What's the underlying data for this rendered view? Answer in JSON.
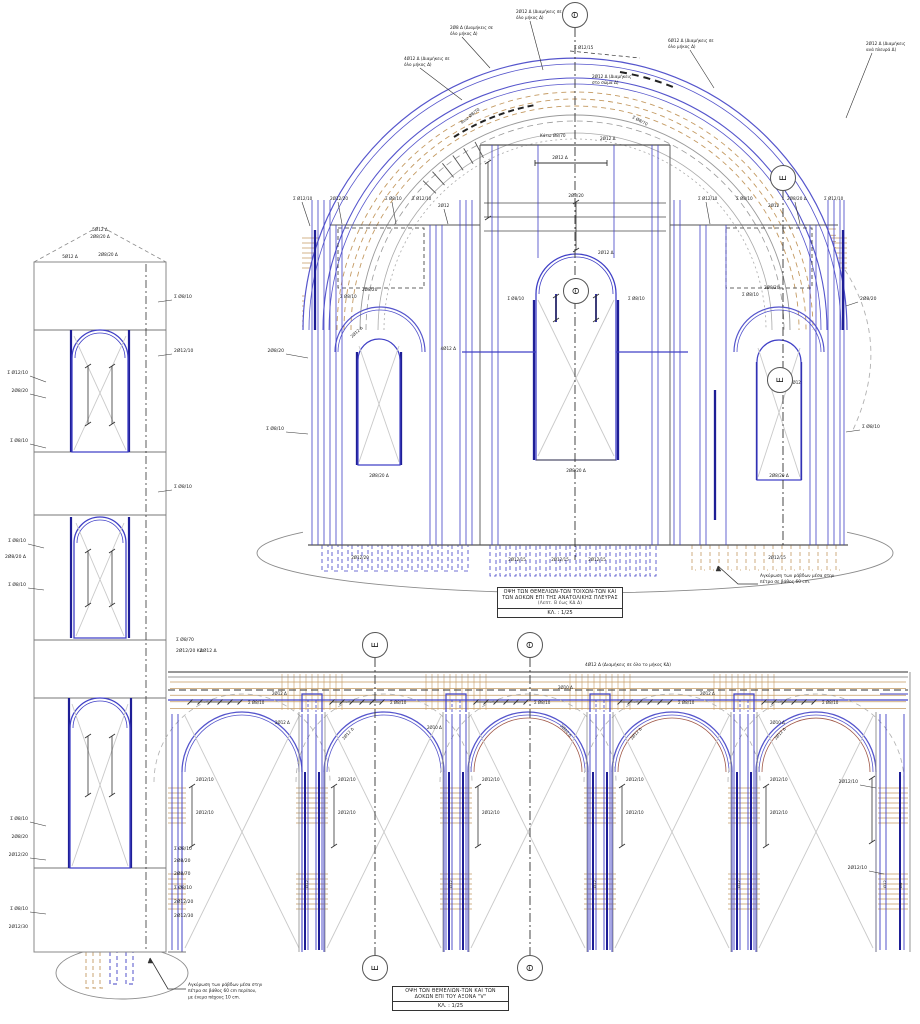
{
  "drawing": {
    "title_block_east": {
      "line1": "ΟΨΗ ΤΩΝ ΘΕΜΕΛΙΩΝ-ΤΩΝ ΤΟΙΧΩΝ-ΤΩΝ ΚΑΙ",
      "line2": "ΤΩΝ ΔΟΚΩΝ ΕΠΙ ΤΗΣ ΑΝΑΤΟΛΙΚΗΣ ΠΛΕΥΡΑΣ",
      "line3": "(Λεπτ. Β έως ΚΔ Δ)",
      "scale": "ΚΛ. : 1/25"
    },
    "title_block_axis_v": {
      "line1": "ΟΨΗ ΤΩΝ ΘΕΜΕΛΙΩΝ-ΤΩΝ ΚΑΙ ΤΩΝ",
      "line2": "ΔΟΚΩΝ ΕΠΙ ΤΟΥ ΑΞΟΝΑ \"V\"",
      "scale": "ΚΛ. : 1/25"
    },
    "colors": {
      "rebar_blue": "#4040c6",
      "rebar_navy": "#1e1e96",
      "arc_blue": "#5555cc",
      "stirrup_tan": "#c49a62",
      "outline_gray": "#8a8a8a",
      "cross_gray": "#c9c9c9",
      "axis_black": "#333333",
      "accent_brown": "#a05848"
    },
    "axis_markers": [
      {
        "glyph": "Θ",
        "x": 575,
        "y": 15,
        "line": [
          575,
          28,
          575,
          560
        ]
      },
      {
        "glyph": "E",
        "x": 783,
        "y": 178,
        "line": [
          783,
          191,
          783,
          545
        ]
      },
      {
        "glyph": "Θ",
        "x": 576,
        "y": 291
      },
      {
        "glyph": "E",
        "x": 780,
        "y": 380
      },
      {
        "glyph": "E",
        "x": 375,
        "y": 645,
        "line": [
          375,
          658,
          375,
          955
        ]
      },
      {
        "glyph": "Θ",
        "x": 530,
        "y": 645,
        "line": [
          530,
          658,
          530,
          955
        ]
      },
      {
        "glyph": "E",
        "x": 375,
        "y": 968
      },
      {
        "glyph": "Θ",
        "x": 530,
        "y": 968
      }
    ],
    "notes": {
      "tower_anchor_1": "Αγκύρωση των ράβδων μέσα στην",
      "tower_anchor_2": "πέτρα σε βάθος 60 cm περίπου,",
      "tower_anchor_3": "με ένεμα πάχους 10 cm.",
      "facade_anchor_1": "Αγκύρωση των ράβδων μέσα στην",
      "facade_anchor_2": "πέτρα σε βάθος 60 cm."
    },
    "ann": [
      {
        "t": "5Ø12 Δ",
        "x": 100,
        "y": 231,
        "a": "m",
        "s": 4.2
      },
      {
        "t": "2Ø8/20 Δ",
        "x": 100,
        "y": 238,
        "a": "m",
        "s": 4.2
      },
      {
        "t": "2Ø8/20 Δ",
        "x": 108,
        "y": 256,
        "a": "m",
        "s": 4.2
      },
      {
        "t": "5Ø12 Δ",
        "x": 70,
        "y": 258,
        "a": "m",
        "s": 4.2
      },
      {
        "t": "Σ Ø12/10",
        "x": 28,
        "y": 374,
        "a": "e",
        "ld": [
          [
            30,
            376
          ],
          [
            46,
            382
          ]
        ]
      },
      {
        "t": "2Ø8/20",
        "x": 28,
        "y": 392,
        "a": "e",
        "ld": [
          [
            30,
            394
          ],
          [
            46,
            398
          ]
        ]
      },
      {
        "t": "Σ Ø8/10",
        "x": 28,
        "y": 442,
        "a": "e",
        "ld": [
          [
            30,
            444
          ],
          [
            46,
            448
          ]
        ]
      },
      {
        "t": "Σ Ø8/10",
        "x": 26,
        "y": 542,
        "a": "e",
        "ld": [
          [
            28,
            544
          ],
          [
            44,
            548
          ]
        ]
      },
      {
        "t": "2Ø8/20 Δ",
        "x": 26,
        "y": 558,
        "a": "e"
      },
      {
        "t": "Σ Ø8/10",
        "x": 26,
        "y": 586,
        "a": "e",
        "ld": [
          [
            28,
            588
          ],
          [
            44,
            590
          ]
        ]
      },
      {
        "t": "Σ Ø8/10",
        "x": 28,
        "y": 820,
        "a": "e",
        "ld": [
          [
            30,
            822
          ],
          [
            46,
            826
          ]
        ]
      },
      {
        "t": "2Ø8/20",
        "x": 28,
        "y": 838,
        "a": "e"
      },
      {
        "t": "2Ø12/20",
        "x": 28,
        "y": 856,
        "a": "e",
        "ld": [
          [
            30,
            858
          ],
          [
            46,
            860
          ]
        ]
      },
      {
        "t": "Σ Ø8/10",
        "x": 28,
        "y": 910,
        "a": "e",
        "ld": [
          [
            30,
            912
          ],
          [
            46,
            914
          ]
        ]
      },
      {
        "t": "2Ø12/30",
        "x": 28,
        "y": 928,
        "a": "e"
      },
      {
        "t": "Σ Ø8/10",
        "x": 174,
        "y": 298,
        "ld": [
          [
            172,
            300
          ],
          [
            158,
            302
          ]
        ]
      },
      {
        "t": "2Ø12/10",
        "x": 174,
        "y": 352,
        "ld": [
          [
            172,
            354
          ],
          [
            158,
            356
          ]
        ]
      },
      {
        "t": "Σ Ø8/10",
        "x": 174,
        "y": 488,
        "ld": [
          [
            172,
            490
          ],
          [
            158,
            492
          ]
        ]
      },
      {
        "t": "Σ Ø8/70",
        "x": 176,
        "y": 641
      },
      {
        "t": "2Ø12/20 ΚΔ",
        "x": 176,
        "y": 652
      },
      {
        "t": "2Ø12 Δ",
        "x": 200,
        "y": 652
      },
      {
        "t": "Σ Ø8/10",
        "x": 174,
        "y": 850
      },
      {
        "t": "2Ø8/20",
        "x": 174,
        "y": 862
      },
      {
        "t": "2Ø8/70",
        "x": 174,
        "y": 875
      },
      {
        "t": "Σ Ø8/10",
        "x": 174,
        "y": 889
      },
      {
        "t": "2Ø12/20",
        "x": 174,
        "y": 903
      },
      {
        "t": "2Ø12/30",
        "x": 174,
        "y": 917
      },
      {
        "t": "2Ø12 Δ (Διαμήκεις σε",
        "x": 516,
        "y": 13,
        "s": 4.2,
        "ld": [
          [
            530,
            21
          ],
          [
            543,
            70
          ]
        ]
      },
      {
        "t": "όλο μήκος Δ)",
        "x": 516,
        "y": 19,
        "s": 4.2
      },
      {
        "t": "2Ø8 Δ (Διαμήκεις σε",
        "x": 450,
        "y": 29,
        "s": 4.2,
        "ld": [
          [
            462,
            37
          ],
          [
            490,
            68
          ]
        ]
      },
      {
        "t": "όλο μήκος Δ)",
        "x": 450,
        "y": 35,
        "s": 4.2
      },
      {
        "t": "4Ø12 Δ (Διαμήκεις σε",
        "x": 404,
        "y": 60,
        "s": 4.2,
        "ld": [
          [
            420,
            68
          ],
          [
            462,
            100
          ]
        ]
      },
      {
        "t": "όλο μήκος Δ)",
        "x": 404,
        "y": 66,
        "s": 4.2
      },
      {
        "t": "6Ø12 Δ (Διαμήκεις σε",
        "x": 668,
        "y": 42,
        "s": 4.2,
        "ld": [
          [
            690,
            50
          ],
          [
            714,
            88
          ]
        ]
      },
      {
        "t": "όλο μήκος Δ)",
        "x": 668,
        "y": 48,
        "s": 4.2
      },
      {
        "t": "2Ø12 Δ (Διαμήκεις",
        "x": 866,
        "y": 45,
        "s": 4.2,
        "ld": [
          [
            872,
            53
          ],
          [
            846,
            118
          ]
        ]
      },
      {
        "t": "ανά πλευρά Δ)",
        "x": 866,
        "y": 51,
        "s": 4.2
      },
      {
        "t": "Σ Ø12/15",
        "x": 574,
        "y": 49,
        "s": 4.2
      },
      {
        "t": "2Ø12 Δ (Διαμήκεις",
        "x": 592,
        "y": 78,
        "s": 4.2
      },
      {
        "t": "στο σώμα Δ)",
        "x": 592,
        "y": 84,
        "s": 4.2
      },
      {
        "t": "Άνω Ø8/70",
        "x": 462,
        "y": 124,
        "s": 4.2,
        "r": -38
      },
      {
        "t": "Σ Ø8/70",
        "x": 632,
        "y": 118,
        "s": 4.2,
        "r": 28
      },
      {
        "t": "Κάτω Ø8/70",
        "x": 540,
        "y": 137,
        "s": 4.2
      },
      {
        "t": "2Ø12 Δ",
        "x": 600,
        "y": 140,
        "s": 4.2
      },
      {
        "t": "Σ Ø12/10",
        "x": 293,
        "y": 200,
        "s": 4.2,
        "ld": [
          [
            302,
            202
          ],
          [
            310,
            226
          ]
        ]
      },
      {
        "t": "2Ø12/20",
        "x": 330,
        "y": 200,
        "s": 4.2,
        "ld": [
          [
            338,
            202
          ],
          [
            342,
            224
          ]
        ]
      },
      {
        "t": "Σ Ø8/10",
        "x": 385,
        "y": 200,
        "s": 4.2,
        "ld": [
          [
            392,
            202
          ],
          [
            396,
            224
          ]
        ]
      },
      {
        "t": "Σ Ø12/10",
        "x": 412,
        "y": 200,
        "s": 4.2
      },
      {
        "t": "2Ø12",
        "x": 438,
        "y": 207,
        "s": 4.2,
        "ld": [
          [
            444,
            209
          ],
          [
            448,
            224
          ]
        ]
      },
      {
        "t": "Σ Ø12/10",
        "x": 698,
        "y": 200,
        "s": 4.2,
        "ld": [
          [
            706,
            202
          ],
          [
            710,
            224
          ]
        ]
      },
      {
        "t": "Σ Ø8/10",
        "x": 736,
        "y": 200,
        "s": 4.2
      },
      {
        "t": "2Ø8/20 Δ",
        "x": 787,
        "y": 200,
        "s": 4.2,
        "ld": [
          [
            795,
            202
          ],
          [
            800,
            224
          ]
        ]
      },
      {
        "t": "Σ Ø12/10",
        "x": 824,
        "y": 200,
        "s": 4.2
      },
      {
        "t": "2Ø12",
        "x": 768,
        "y": 207,
        "s": 4.2
      },
      {
        "t": "2Ø12 Δ",
        "x": 560,
        "y": 159,
        "a": "m",
        "s": 4.2
      },
      {
        "t": "2Ø8/20",
        "x": 576,
        "y": 197,
        "a": "m",
        "s": 4.2
      },
      {
        "t": "4Ø12 Δ",
        "x": 456,
        "y": 350,
        "a": "e",
        "s": 4.2
      },
      {
        "t": "2Ø12 Δ",
        "x": 598,
        "y": 254,
        "s": 4.2
      },
      {
        "t": "Σ Ø8/10",
        "x": 524,
        "y": 300,
        "a": "e",
        "s": 4.2
      },
      {
        "t": "Σ Ø8/10",
        "x": 628,
        "y": 300,
        "s": 4.2
      },
      {
        "t": "2Ø8/20 Δ",
        "x": 576,
        "y": 472,
        "a": "m",
        "s": 4.2
      },
      {
        "t": "Σ Ø8/10",
        "x": 340,
        "y": 298,
        "s": 4.2
      },
      {
        "t": "2Ø8/20",
        "x": 362,
        "y": 291,
        "s": 4.2
      },
      {
        "t": "2Ø12 Δ",
        "x": 352,
        "y": 338,
        "s": 4,
        "r": -42
      },
      {
        "t": "2Ø8/20 Δ",
        "x": 379,
        "y": 477,
        "a": "m",
        "s": 4.2
      },
      {
        "t": "2Ø8/20",
        "x": 284,
        "y": 352,
        "a": "e",
        "ld": [
          [
            286,
            354
          ],
          [
            308,
            358
          ]
        ]
      },
      {
        "t": "Σ Ø8/10",
        "x": 284,
        "y": 430,
        "a": "e",
        "ld": [
          [
            286,
            432
          ],
          [
            308,
            434
          ]
        ]
      },
      {
        "t": "Σ Ø8/10",
        "x": 742,
        "y": 296,
        "s": 4.2
      },
      {
        "t": "2Ø8/20",
        "x": 764,
        "y": 289,
        "s": 4.2
      },
      {
        "t": "2Ø12",
        "x": 790,
        "y": 384,
        "s": 4
      },
      {
        "t": "2Ø8/20",
        "x": 860,
        "y": 300,
        "ld": [
          [
            858,
            302
          ],
          [
            846,
            306
          ]
        ]
      },
      {
        "t": "Σ Ø8/10",
        "x": 862,
        "y": 428,
        "ld": [
          [
            860,
            430
          ],
          [
            846,
            432
          ]
        ]
      },
      {
        "t": "2Ø8/20 Δ",
        "x": 779,
        "y": 477,
        "a": "m",
        "s": 4.2
      },
      {
        "t": "2Ø12/20",
        "x": 360,
        "y": 559,
        "a": "m",
        "s": 4.1
      },
      {
        "t": "2Ø12/15",
        "x": 517,
        "y": 561,
        "a": "m",
        "s": 4.1
      },
      {
        "t": "2Ø12/15",
        "x": 560,
        "y": 561,
        "a": "m",
        "s": 4.1
      },
      {
        "t": "2Ø12/15",
        "x": 597,
        "y": 561,
        "a": "m",
        "s": 4.1
      },
      {
        "t": "2Ø12/15",
        "x": 777,
        "y": 559,
        "a": "m",
        "s": 4.1
      },
      {
        "t": "4Ø12 Δ (Διαμήκεις σε όλο το μήκος ΚΔ)",
        "x": 585,
        "y": 666,
        "s": 4.3
      },
      {
        "t": "Σ Ø8/10",
        "x": 248,
        "y": 704,
        "s": 4.1
      },
      {
        "t": "Σ Ø8/10",
        "x": 390,
        "y": 704,
        "s": 4.1
      },
      {
        "t": "Σ Ø8/10",
        "x": 534,
        "y": 704,
        "s": 4.1
      },
      {
        "t": "Σ Ø8/10",
        "x": 678,
        "y": 704,
        "s": 4.1
      },
      {
        "t": "Σ Ø8/10",
        "x": 822,
        "y": 704,
        "s": 4.1
      },
      {
        "t": "2Ø12 Δ",
        "x": 272,
        "y": 695,
        "s": 4
      },
      {
        "t": "2Ø12 Δ",
        "x": 275,
        "y": 724,
        "s": 4
      },
      {
        "t": "2Ø10 Δ",
        "x": 558,
        "y": 689,
        "s": 4
      },
      {
        "t": "2Ø10 Δ",
        "x": 427,
        "y": 729,
        "s": 4
      },
      {
        "t": "2Ø12 Δ",
        "x": 700,
        "y": 695,
        "s": 4
      },
      {
        "t": "2Ø10 Δ",
        "x": 770,
        "y": 724,
        "s": 4
      },
      {
        "t": "2Ø12 Δ",
        "x": 344,
        "y": 740,
        "s": 4,
        "r": -48
      },
      {
        "t": "2Ø12 Δ",
        "x": 632,
        "y": 740,
        "s": 4,
        "r": -48
      },
      {
        "t": "2Ø12 Δ",
        "x": 776,
        "y": 740,
        "s": 4,
        "r": -48
      },
      {
        "t": "2Ø10 Δ",
        "x": 560,
        "y": 726,
        "s": 4,
        "r": 48
      },
      {
        "t": "2Ø12/10",
        "x": 196,
        "y": 781,
        "s": 4.1
      },
      {
        "t": "2Ø12/10",
        "x": 196,
        "y": 814,
        "s": 4.1
      },
      {
        "t": "2Ø12/10",
        "x": 338,
        "y": 781,
        "s": 4.1
      },
      {
        "t": "2Ø12/10",
        "x": 338,
        "y": 814,
        "s": 4.1
      },
      {
        "t": "2Ø12/10",
        "x": 482,
        "y": 781,
        "s": 4.1
      },
      {
        "t": "2Ø12/10",
        "x": 482,
        "y": 814,
        "s": 4.1
      },
      {
        "t": "2Ø12/10",
        "x": 626,
        "y": 781,
        "s": 4.1
      },
      {
        "t": "2Ø12/10",
        "x": 626,
        "y": 814,
        "s": 4.1
      },
      {
        "t": "2Ø12/10",
        "x": 770,
        "y": 781,
        "s": 4.1
      },
      {
        "t": "2Ø12/10",
        "x": 770,
        "y": 814,
        "s": 4.1
      },
      {
        "t": "2Ø12/10",
        "x": 858,
        "y": 783,
        "a": "e",
        "ld": [
          [
            860,
            785
          ],
          [
            876,
            788
          ]
        ]
      },
      {
        "t": "2Ø12/10",
        "x": 867,
        "y": 869,
        "a": "e",
        "ld": [
          [
            869,
            871
          ],
          [
            884,
            874
          ]
        ]
      },
      {
        "t": "Ø12",
        "x": 308,
        "y": 888,
        "s": 3.8,
        "r": -90
      },
      {
        "t": "Ø12",
        "x": 452,
        "y": 888,
        "s": 3.8,
        "r": -90
      },
      {
        "t": "Ø12",
        "x": 596,
        "y": 888,
        "s": 3.8,
        "r": -90
      },
      {
        "t": "Ø12",
        "x": 740,
        "y": 888,
        "s": 3.8,
        "r": -90
      },
      {
        "t": "Ø12",
        "x": 886,
        "y": 888,
        "s": 3.8,
        "r": -90
      },
      {
        "t": "Ø8",
        "x": 902,
        "y": 888,
        "s": 3.8,
        "r": -90
      }
    ]
  }
}
